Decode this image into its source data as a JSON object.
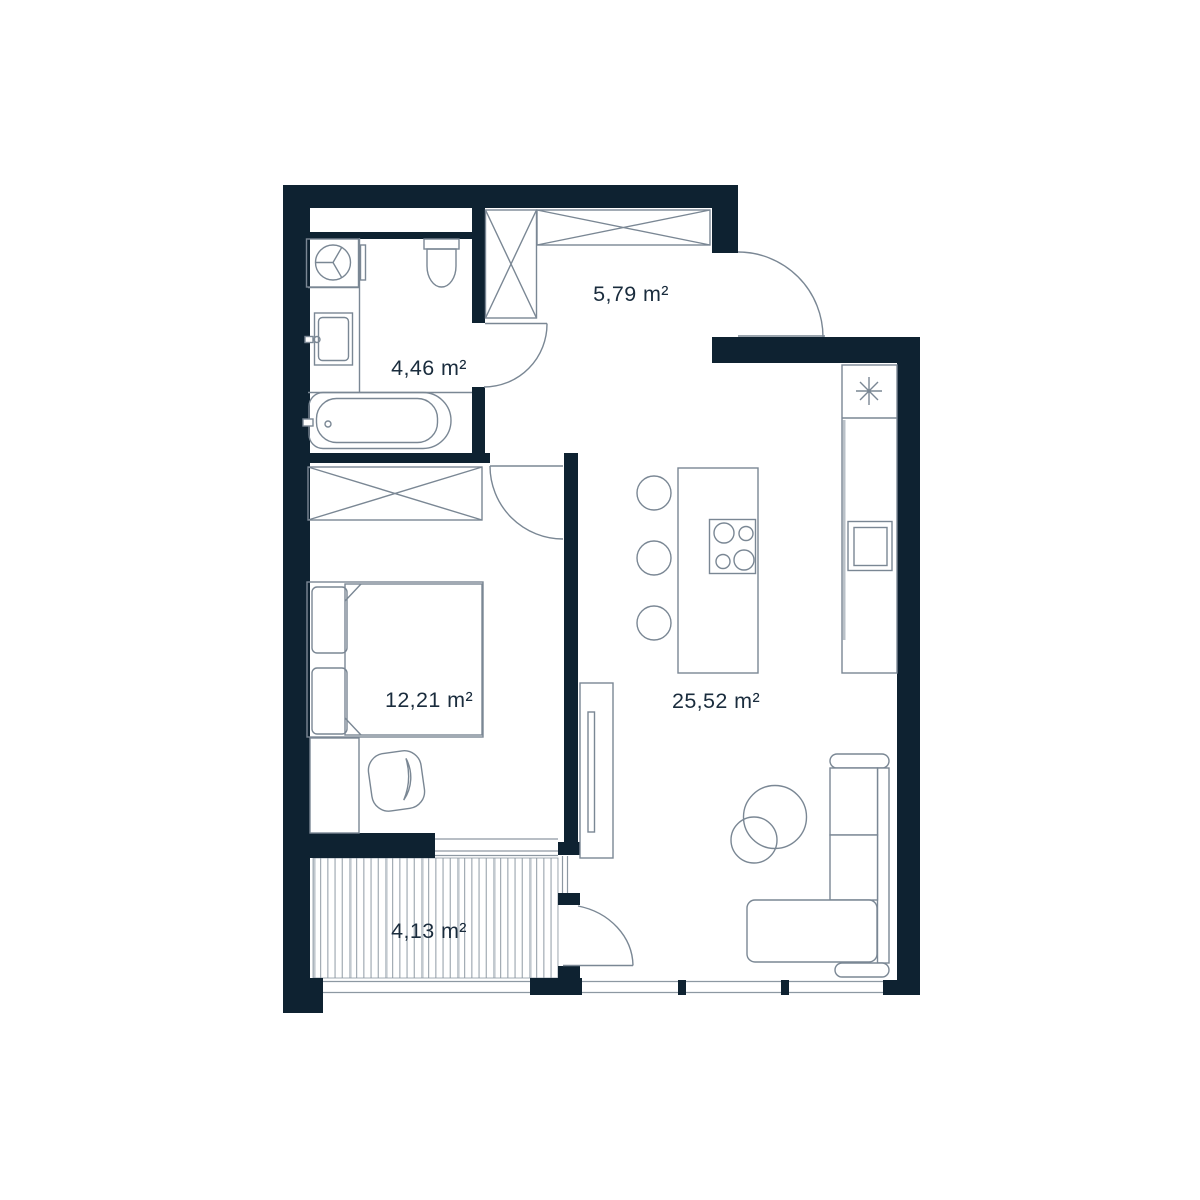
{
  "plan": {
    "type": "apartment-floor-plan",
    "unit": "m²",
    "rooms": [
      {
        "id": "hallway",
        "area_label": "5,79 m²"
      },
      {
        "id": "bathroom",
        "area_label": "4,46 m²"
      },
      {
        "id": "bedroom",
        "area_label": "12,21 m²"
      },
      {
        "id": "living-kitchen",
        "area_label": "25,52 m²"
      },
      {
        "id": "balcony",
        "area_label": "4,13 m²"
      }
    ],
    "colors": {
      "wall": "#0E2231",
      "furniture_line": "#7A8794",
      "window_line": "#8D98A2",
      "deck_stripe": "#9AA4AD",
      "deck_stripe_light": "#C2C9CF",
      "text": "#1A2C3D",
      "background": "#FFFFFF"
    },
    "icons": [
      "washing-machine-icon",
      "toilet-icon",
      "sink-icon",
      "bathtub-icon",
      "wardrobe-cross-icon",
      "bed-icon",
      "armchair-icon",
      "tv-icon",
      "kitchen-island-icon",
      "cooktop-icon",
      "stool-icon",
      "kitchen-sink-icon",
      "light-asterisk-icon",
      "sofa-icon",
      "coffee-table-icon",
      "door-arc-icon"
    ]
  }
}
